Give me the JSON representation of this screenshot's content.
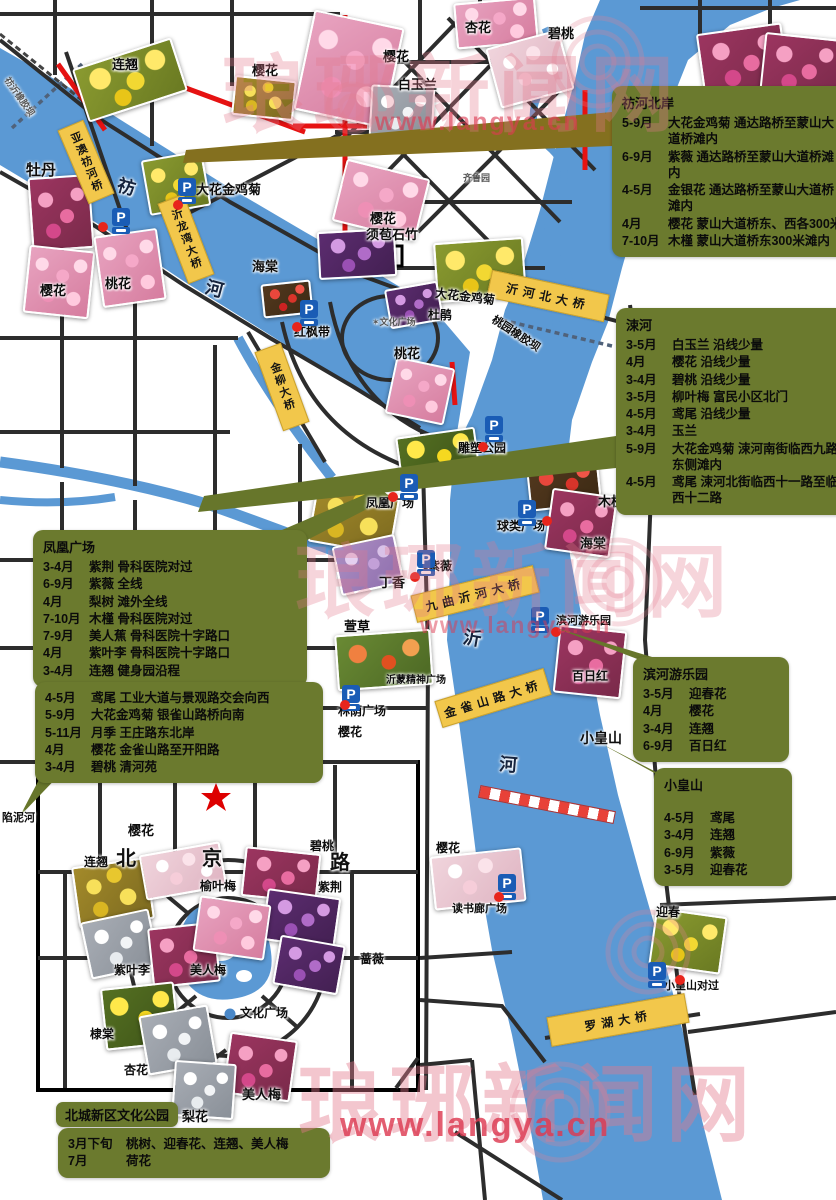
{
  "watermark": {
    "brand": "琅琊新闻网",
    "url": "www.langya.cn",
    "texts": [
      {
        "x": 222,
        "y": 28,
        "s": 84,
        "o": 0.32
      },
      {
        "x": 295,
        "y": 518,
        "s": 80,
        "o": 0.3
      },
      {
        "x": 298,
        "y": 1038,
        "s": 84,
        "o": 0.42
      }
    ],
    "urls": [
      {
        "x": 375,
        "y": 108,
        "s": 25,
        "o": 0.62
      },
      {
        "x": 420,
        "y": 612,
        "s": 23,
        "o": 0.5
      },
      {
        "x": 340,
        "y": 1106,
        "s": 34,
        "o": 0.82
      }
    ]
  },
  "colors": {
    "olive": "#6b7a2e",
    "river": "#5b99d4",
    "bridge": "#f2c74b",
    "red_road": "#e61212",
    "poi_dot": "#e8251c",
    "parking_blue": "#1a5cb5"
  },
  "icons": {
    "parking": "P"
  },
  "callouts": [
    {
      "id": "benghe-beian",
      "t": "祊河北岸",
      "x": 612,
      "y": 86,
      "w": 224,
      "lines": [
        [
          "5-9月",
          "大花金鸡菊  通达路桥至蒙山大道桥滩内"
        ],
        [
          "6-9月",
          "紫薇  通达路桥至蒙山大道桥滩内"
        ],
        [
          "4-5月",
          "金银花  通达路桥至蒙山大道桥滩内"
        ],
        [
          "4月",
          "樱花  蒙山大道桥东、西各300米"
        ],
        [
          "7-10月",
          "木槿  蒙山大道桥东300米滩内"
        ]
      ]
    },
    {
      "id": "suhe",
      "t": "涑河",
      "x": 616,
      "y": 308,
      "w": 220,
      "lines": [
        [
          "3-5月",
          "白玉兰  沿线少量"
        ],
        [
          "4月",
          "樱花  沿线少量"
        ],
        [
          "3-4月",
          "碧桃  沿线少量"
        ],
        [
          "3-5月",
          "柳叶梅  富民小区北门"
        ],
        [
          "4-5月",
          "鸢尾  沿线少量"
        ],
        [
          "3-4月",
          "玉兰"
        ],
        [
          "5-9月",
          "大花金鸡菊 涑河南街临西九路东侧滩内"
        ],
        [
          "4-5月",
          "鸢尾 涑河北街临西十一路至临西十二路"
        ]
      ]
    },
    {
      "id": "fenghuang-guangchang",
      "t": "凤凰广场",
      "x": 33,
      "y": 530,
      "w": 254,
      "lines": [
        [
          "3-4月",
          "紫荆  骨科医院对过"
        ],
        [
          "6-9月",
          "紫薇   全线"
        ],
        [
          "4月",
          "梨树  滩外全线"
        ],
        [
          "7-10月",
          "木槿  骨科医院对过"
        ],
        [
          "7-9月",
          "美人蕉  骨科医院十字路口"
        ],
        [
          "4月",
          "紫叶李  骨科医院十字路口"
        ],
        [
          "3-4月",
          "连翘   健身园沿程"
        ]
      ]
    },
    {
      "id": "gongye-dadao",
      "t": "",
      "x": 35,
      "y": 682,
      "w": 268,
      "lines": [
        [
          "4-5月",
          "鸢尾  工业大道与景观路交会向西"
        ],
        [
          "5-9月",
          "大花金鸡菊  银雀山路桥向南"
        ],
        [
          "5-11月",
          "月季  王庄路东北岸"
        ],
        [
          "4月",
          "樱花  金雀山路至开阳路"
        ],
        [
          "3-4月",
          "碧桃  清河苑"
        ]
      ]
    },
    {
      "id": "binhe-youleyuan",
      "t": "滨河游乐园",
      "x": 633,
      "y": 657,
      "w": 136,
      "lines": [
        [
          "3-5月",
          "迎春花"
        ],
        [
          "4月",
          "樱花"
        ],
        [
          "3-4月",
          "连翘"
        ],
        [
          "6-9月",
          "百日红"
        ]
      ]
    },
    {
      "id": "xiaohuangshan",
      "t": "小皇山",
      "x": 654,
      "y": 768,
      "w": 118,
      "cls": "gap",
      "lines": [
        [
          "4-5月",
          "鸢尾"
        ],
        [
          "3-4月",
          "连翘"
        ],
        [
          "6-9月",
          "紫薇"
        ],
        [
          "3-5月",
          "迎春花"
        ]
      ]
    },
    {
      "id": "beicheng-chip",
      "t": "北城新区文化公园",
      "x": 56,
      "y": 1102,
      "w": 0,
      "cls": "chip",
      "lines": []
    },
    {
      "id": "beicheng-schedule",
      "t": "",
      "x": 58,
      "y": 1128,
      "w": 252,
      "cls": "wide-m",
      "lines": [
        [
          "3月下旬",
          "桃树、迎春花、连翘、美人梅"
        ],
        [
          "7月",
          "荷花"
        ]
      ]
    }
  ],
  "bridges": [
    {
      "t": "亚澳祊河桥",
      "x": 72,
      "y": 122,
      "w": 26,
      "h": 78,
      "r": -23,
      "v": true
    },
    {
      "t": "沂龙湾大桥",
      "x": 172,
      "y": 196,
      "w": 26,
      "h": 84,
      "r": -21,
      "v": true
    },
    {
      "t": "金柳大桥",
      "x": 268,
      "y": 345,
      "w": 26,
      "h": 82,
      "r": -20,
      "v": true
    },
    {
      "t": "沂河北大桥",
      "x": 488,
      "y": 282,
      "w": 118,
      "h": 26,
      "r": 12,
      "v": false
    },
    {
      "t": "九曲沂河大桥",
      "x": 412,
      "y": 580,
      "w": 124,
      "h": 26,
      "r": -14,
      "v": false
    },
    {
      "t": "金雀山路大桥",
      "x": 436,
      "y": 684,
      "w": 112,
      "h": 26,
      "r": -17,
      "v": false
    },
    {
      "t": "罗湖大桥",
      "x": 548,
      "y": 1005,
      "w": 138,
      "h": 28,
      "r": -10,
      "v": false
    }
  ],
  "labels": [
    {
      "t": "连翘",
      "x": 112,
      "y": 58
    },
    {
      "t": "樱花",
      "x": 252,
      "y": 64
    },
    {
      "t": "樱花",
      "x": 383,
      "y": 50
    },
    {
      "t": "白玉兰",
      "x": 398,
      "y": 78
    },
    {
      "t": "杏花",
      "x": 465,
      "y": 21
    },
    {
      "t": "碧桃",
      "x": 548,
      "y": 27
    },
    {
      "t": "牡丹",
      "x": 26,
      "y": 163,
      "s": 15
    },
    {
      "t": "大花金鸡菊",
      "x": 196,
      "y": 183
    },
    {
      "t": "樱花",
      "x": 40,
      "y": 284
    },
    {
      "t": "桃花",
      "x": 105,
      "y": 277
    },
    {
      "t": "海棠",
      "x": 252,
      "y": 260
    },
    {
      "t": "樱花",
      "x": 370,
      "y": 212
    },
    {
      "t": "须苞石竹",
      "x": 366,
      "y": 228
    },
    {
      "t": "齐鲁园",
      "x": 463,
      "y": 174,
      "s": 9,
      "c": "dim"
    },
    {
      "t": "红枫带",
      "x": 294,
      "y": 326,
      "s": 12
    },
    {
      "t": "✶文化广场",
      "x": 372,
      "y": 318,
      "s": 9,
      "c": "dim"
    },
    {
      "t": "杜鹃",
      "x": 428,
      "y": 309,
      "s": 12
    },
    {
      "t": "桃花",
      "x": 394,
      "y": 347
    },
    {
      "t": "大花金鸡菊",
      "x": 436,
      "y": 287,
      "s": 12,
      "r": 7
    },
    {
      "t": "桃园橡胶坝",
      "x": 496,
      "y": 314,
      "s": 11,
      "r": 33
    },
    {
      "t": "祊沂橡胶坝",
      "x": 10,
      "y": 76,
      "s": 9,
      "r": 55,
      "c": "dim"
    },
    {
      "t": "雕塑公园",
      "x": 458,
      "y": 442,
      "s": 12
    },
    {
      "t": "凤凰广场",
      "x": 366,
      "y": 497,
      "s": 12
    },
    {
      "t": "海棠",
      "x": 580,
      "y": 537
    },
    {
      "t": "木槿",
      "x": 598,
      "y": 495
    },
    {
      "t": "球类广场",
      "x": 497,
      "y": 520,
      "s": 12
    },
    {
      "t": "紫薇",
      "x": 428,
      "y": 560,
      "s": 12
    },
    {
      "t": "丁香",
      "x": 379,
      "y": 576
    },
    {
      "t": "萱草",
      "x": 344,
      "y": 620
    },
    {
      "t": "沂蒙精神广场",
      "x": 386,
      "y": 675,
      "s": 10
    },
    {
      "t": "林荫广场",
      "x": 338,
      "y": 705,
      "s": 12
    },
    {
      "t": "樱花",
      "x": 338,
      "y": 726,
      "s": 12
    },
    {
      "t": "滨河游乐园",
      "x": 556,
      "y": 615,
      "s": 11
    },
    {
      "t": "百日红",
      "x": 572,
      "y": 670,
      "s": 12
    },
    {
      "t": "小皇山",
      "x": 580,
      "y": 731,
      "s": 14
    },
    {
      "t": "樱花",
      "x": 436,
      "y": 842,
      "s": 12
    },
    {
      "t": "读书廊广场",
      "x": 452,
      "y": 903,
      "s": 11
    },
    {
      "t": "迎春",
      "x": 656,
      "y": 906,
      "s": 12
    },
    {
      "t": "小皇山对过",
      "x": 664,
      "y": 980,
      "s": 11
    },
    {
      "t": "陷泥河",
      "x": 2,
      "y": 812,
      "s": 11
    },
    {
      "t": "梨花",
      "x": 182,
      "y": 1110
    },
    {
      "t": "美人梅",
      "x": 242,
      "y": 1088
    },
    {
      "t": "樱花",
      "x": 128,
      "y": 824
    },
    {
      "t": "连翘",
      "x": 84,
      "y": 856,
      "s": 12
    },
    {
      "t": "碧桃",
      "x": 310,
      "y": 840,
      "s": 12
    },
    {
      "t": "紫荆",
      "x": 318,
      "y": 881,
      "s": 12
    },
    {
      "t": "榆叶梅",
      "x": 200,
      "y": 880,
      "s": 12
    },
    {
      "t": "蔷薇",
      "x": 360,
      "y": 953,
      "s": 12
    },
    {
      "t": "紫叶李",
      "x": 114,
      "y": 964,
      "s": 12
    },
    {
      "t": "美人梅",
      "x": 190,
      "y": 964,
      "s": 12
    },
    {
      "t": "棣棠",
      "x": 90,
      "y": 1028,
      "s": 12
    },
    {
      "t": "杏花",
      "x": 124,
      "y": 1064,
      "s": 12
    },
    {
      "t": "文化广场",
      "x": 240,
      "y": 1007,
      "s": 12
    },
    {
      "t": "北",
      "x": 116,
      "y": 848,
      "s": 20,
      "c": "rd"
    },
    {
      "t": "京",
      "x": 202,
      "y": 848,
      "s": 20,
      "c": "rd"
    },
    {
      "t": "路",
      "x": 330,
      "y": 852,
      "s": 20,
      "c": "rd"
    },
    {
      "t": "祊",
      "x": 120,
      "y": 176,
      "s": 18,
      "r": 15,
      "c": "riv"
    },
    {
      "t": "河",
      "x": 208,
      "y": 278,
      "s": 18,
      "r": 15,
      "c": "riv"
    },
    {
      "t": "沂",
      "x": 465,
      "y": 628,
      "s": 18,
      "r": 10,
      "c": "riv"
    },
    {
      "t": "河",
      "x": 500,
      "y": 755,
      "s": 18,
      "r": 5,
      "c": "riv"
    }
  ],
  "parkings": [
    [
      112,
      208
    ],
    [
      178,
      178
    ],
    [
      300,
      300
    ],
    [
      400,
      474
    ],
    [
      485,
      416
    ],
    [
      417,
      550
    ],
    [
      518,
      500
    ],
    [
      531,
      607
    ],
    [
      342,
      685
    ],
    [
      498,
      874
    ],
    [
      648,
      962
    ]
  ],
  "dots": [
    [
      98,
      222
    ],
    [
      173,
      200
    ],
    [
      292,
      322
    ],
    [
      388,
      492
    ],
    [
      478,
      442
    ],
    [
      410,
      572
    ],
    [
      542,
      516
    ],
    [
      551,
      627
    ],
    [
      340,
      700
    ],
    [
      494,
      892
    ],
    [
      675,
      975
    ]
  ],
  "photos": [
    {
      "n": "lianqiao-field",
      "x": 78,
      "y": 52,
      "w": 100,
      "h": 52,
      "r": -18,
      "c": "yellow"
    },
    {
      "n": "lianqiao-north",
      "x": 233,
      "y": 78,
      "w": 58,
      "h": 36,
      "r": 6,
      "c": "golden"
    },
    {
      "n": "yinghua-top",
      "x": 303,
      "y": 18,
      "w": 88,
      "h": 98,
      "r": 12,
      "c": "pink"
    },
    {
      "n": "yinghua-topsmall",
      "x": 455,
      "y": 0,
      "w": 78,
      "h": 42,
      "r": -5,
      "c": "pink"
    },
    {
      "n": "xinghua-stream",
      "x": 492,
      "y": 38,
      "w": 72,
      "h": 58,
      "r": -15,
      "c": "palepink"
    },
    {
      "n": "bitao-a",
      "x": 700,
      "y": 28,
      "w": 82,
      "h": 62,
      "r": -8,
      "c": "deeppink"
    },
    {
      "n": "bitao-b",
      "x": 762,
      "y": 36,
      "w": 76,
      "h": 60,
      "r": 6,
      "c": "deeppink"
    },
    {
      "n": "baiyulan",
      "x": 370,
      "y": 86,
      "w": 60,
      "h": 48,
      "r": 3,
      "c": "white"
    },
    {
      "n": "mudan",
      "x": 30,
      "y": 176,
      "w": 58,
      "h": 70,
      "r": -4,
      "c": "deeppink"
    },
    {
      "n": "jinjiju-north",
      "x": 145,
      "y": 155,
      "w": 58,
      "h": 52,
      "r": -10,
      "c": "yellow"
    },
    {
      "n": "yinghua-mid",
      "x": 338,
      "y": 168,
      "w": 82,
      "h": 60,
      "r": 14,
      "c": "pink"
    },
    {
      "n": "xubaoshizhu",
      "x": 318,
      "y": 230,
      "w": 74,
      "h": 44,
      "r": -3,
      "c": "purple"
    },
    {
      "n": "yinghua-west",
      "x": 26,
      "y": 248,
      "w": 62,
      "h": 64,
      "r": 6,
      "c": "pink"
    },
    {
      "n": "taohua-west",
      "x": 98,
      "y": 232,
      "w": 60,
      "h": 68,
      "r": -8,
      "c": "pink"
    },
    {
      "n": "haitang-north",
      "x": 262,
      "y": 282,
      "w": 46,
      "h": 30,
      "r": -6,
      "c": "red"
    },
    {
      "n": "dahua-jinjiju",
      "x": 435,
      "y": 240,
      "w": 86,
      "h": 56,
      "r": -4,
      "c": "yellow"
    },
    {
      "n": "dujuan",
      "x": 387,
      "y": 285,
      "w": 50,
      "h": 36,
      "r": -10,
      "c": "purple"
    },
    {
      "n": "taohua-south",
      "x": 390,
      "y": 362,
      "w": 56,
      "h": 54,
      "r": 12,
      "c": "pink"
    },
    {
      "n": "ditang",
      "x": 398,
      "y": 432,
      "w": 76,
      "h": 42,
      "r": -8,
      "c": "kerria"
    },
    {
      "n": "lianqiao-south",
      "x": 312,
      "y": 487,
      "w": 80,
      "h": 58,
      "r": 10,
      "c": "golden"
    },
    {
      "n": "haitang-east",
      "x": 528,
      "y": 462,
      "w": 68,
      "h": 42,
      "r": -6,
      "c": "red"
    },
    {
      "n": "mujin",
      "x": 548,
      "y": 492,
      "w": 62,
      "h": 58,
      "r": 8,
      "c": "deeppink"
    },
    {
      "n": "ziwei",
      "x": 336,
      "y": 540,
      "w": 60,
      "h": 46,
      "r": -12,
      "c": "lilac"
    },
    {
      "n": "xuancao",
      "x": 336,
      "y": 632,
      "w": 92,
      "h": 52,
      "r": -4,
      "c": "redgreen"
    },
    {
      "n": "binhe-ziwei",
      "x": 556,
      "y": 628,
      "w": 64,
      "h": 64,
      "r": 6,
      "c": "deeppink"
    },
    {
      "n": "yinghua-dushulang",
      "x": 432,
      "y": 852,
      "w": 88,
      "h": 50,
      "r": -6,
      "c": "palepink"
    },
    {
      "n": "yingchun",
      "x": 652,
      "y": 912,
      "w": 68,
      "h": 54,
      "r": 8,
      "c": "yellow"
    },
    {
      "n": "lianqiao-inset",
      "x": 75,
      "y": 862,
      "w": 72,
      "h": 58,
      "r": -8,
      "c": "golden"
    },
    {
      "n": "yinghua-inset",
      "x": 142,
      "y": 848,
      "w": 78,
      "h": 42,
      "r": -10,
      "c": "palepink"
    },
    {
      "n": "bitao-inset",
      "x": 243,
      "y": 850,
      "w": 72,
      "h": 46,
      "r": 6,
      "c": "deeppink"
    },
    {
      "n": "zijing-inset",
      "x": 264,
      "y": 893,
      "w": 70,
      "h": 48,
      "r": 8,
      "c": "purple"
    },
    {
      "n": "qiangwei-inset",
      "x": 276,
      "y": 940,
      "w": 62,
      "h": 46,
      "r": 10,
      "c": "purple"
    },
    {
      "n": "ziyeli-inset",
      "x": 85,
      "y": 915,
      "w": 66,
      "h": 54,
      "r": -12,
      "c": "white"
    },
    {
      "n": "meirenmei-inset",
      "x": 150,
      "y": 925,
      "w": 64,
      "h": 56,
      "r": -6,
      "c": "deeppink"
    },
    {
      "n": "yuyemei-inset",
      "x": 196,
      "y": 900,
      "w": 68,
      "h": 52,
      "r": 8,
      "c": "pink"
    },
    {
      "n": "ditang-inset",
      "x": 103,
      "y": 985,
      "w": 70,
      "h": 58,
      "r": -6,
      "c": "kerria"
    },
    {
      "n": "xinghua-inset",
      "x": 143,
      "y": 1010,
      "w": 66,
      "h": 56,
      "r": -10,
      "c": "white"
    },
    {
      "n": "meirenmei-south",
      "x": 226,
      "y": 1036,
      "w": 64,
      "h": 58,
      "r": 8,
      "c": "deeppink"
    },
    {
      "n": "lihua-inset",
      "x": 173,
      "y": 1062,
      "w": 58,
      "h": 52,
      "r": 4,
      "c": "white"
    }
  ]
}
